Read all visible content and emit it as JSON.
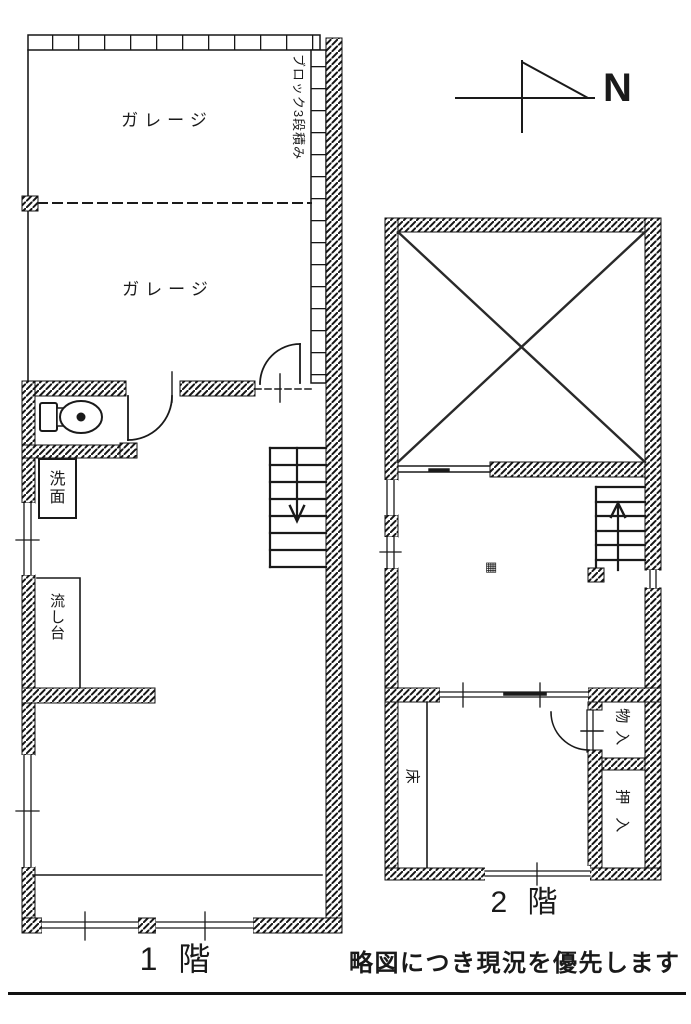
{
  "page": {
    "north_label": "N",
    "disclaimer": "略図につき現況を優先します"
  },
  "floor1": {
    "name_label": "1 階",
    "garage_upper": "ガレージ",
    "garage_lower": "ガレージ",
    "block_wall_note": "ブロック3段積み",
    "washbasin": "洗面",
    "sink": "流し台"
  },
  "floor2": {
    "name_label": "2 階",
    "tokonoma": "床",
    "storage": "物入",
    "closet": "押入",
    "illegible_mark": "▦"
  },
  "colors": {
    "ink": "#1a1a1a",
    "paper": "#ffffff"
  }
}
